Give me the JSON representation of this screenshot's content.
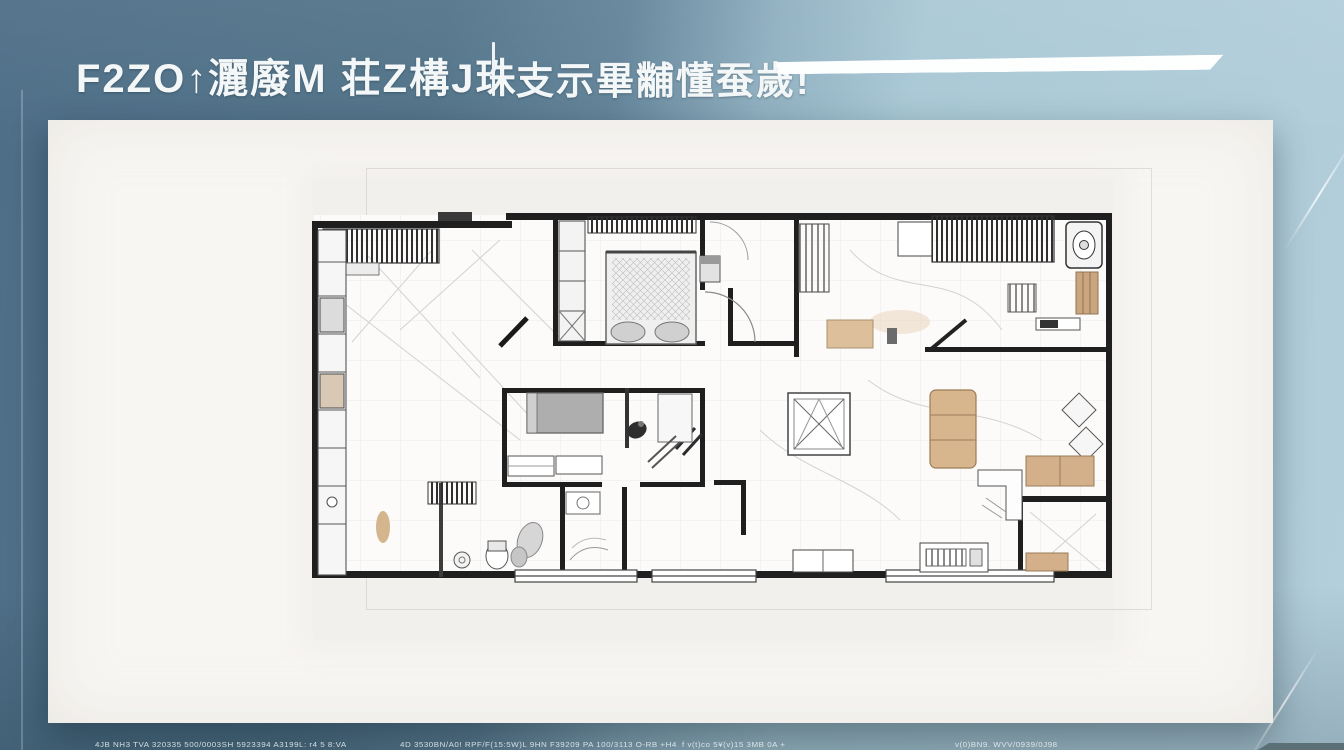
{
  "header": {
    "title_left": "F2ZO↑灑廢M 荘Z構J珠",
    "title_right": "支示畢黼懂蚕歲!"
  },
  "footer": {
    "text_a": "4JB NH3 TVA 320335 500/0003SH 5923394 A3199L: r4 5 8:VA",
    "text_b": "4D 3530BN/A0! RPF/F(15:5W)L 9HN F39209 PA 100/3113  O-RB +H4",
    "text_c": "f  v(t)co 5¥(v)15 3MB 0A +",
    "text_d": "v(0)BN9.  WVV/0939/0J98"
  },
  "colors": {
    "background_left": "#4d6e87",
    "background_right": "#b4cfdc",
    "card": "#f8f6f3",
    "wall": "#1f1f1f",
    "accent_bar": "#fdfefe",
    "furniture_tan": "#d3b089",
    "furniture_grey": "#aeaeae",
    "corner_bar": "#5b7077"
  },
  "plan": {
    "kind": "hand-sketched apartment floor plan",
    "features": [
      "living-room",
      "master-bedroom",
      "center-bedroom",
      "bathrooms",
      "dining-area",
      "balcony-windows",
      "wardrobes",
      "corner-room"
    ]
  }
}
